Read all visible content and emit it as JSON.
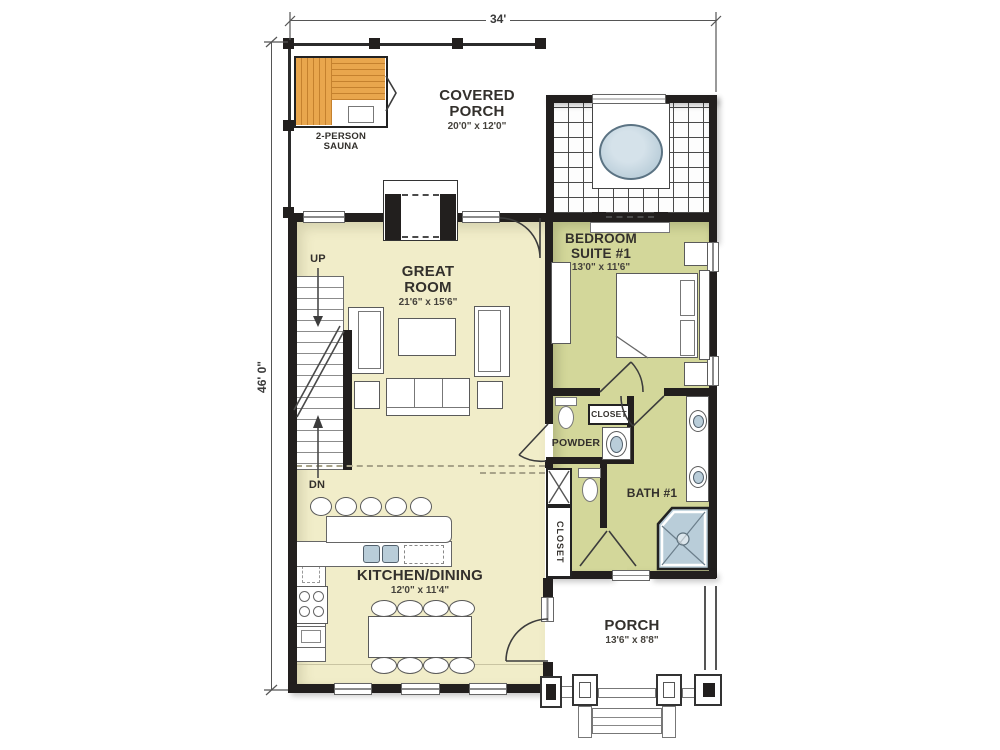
{
  "plan_dimensions": {
    "width_label": "34'",
    "height_label": "46' 0\""
  },
  "rooms": {
    "covered_porch": {
      "name": "COVERED PORCH",
      "size": "20'0\" x 12'0\""
    },
    "sauna": {
      "name": "2-PERSON SAUNA"
    },
    "great_room": {
      "name": "GREAT ROOM",
      "size": "21'6\" x 15'6\""
    },
    "bedroom_suite": {
      "name": "BEDROOM SUITE #1",
      "size": "13'0\" x 11'6\""
    },
    "powder": {
      "name": "POWDER"
    },
    "closet_hall": {
      "name": "CLOSET"
    },
    "closet_entry": {
      "name": "CLOSET"
    },
    "bath": {
      "name": "BATH #1"
    },
    "kitchen_dining": {
      "name": "KITCHEN/DINING",
      "size": "12'0\" x 11'4\""
    },
    "porch": {
      "name": "PORCH",
      "size": "13'6\" x 8'8\""
    }
  },
  "stairs": {
    "up": "UP",
    "down": "DN"
  },
  "colors": {
    "wall": "#221f1e",
    "floor_main": "#f1edc9",
    "floor_suite": "#d3d79a",
    "water": "#b9cdd9",
    "wood": "#e9a64d",
    "wood_dark": "#c5812e"
  }
}
